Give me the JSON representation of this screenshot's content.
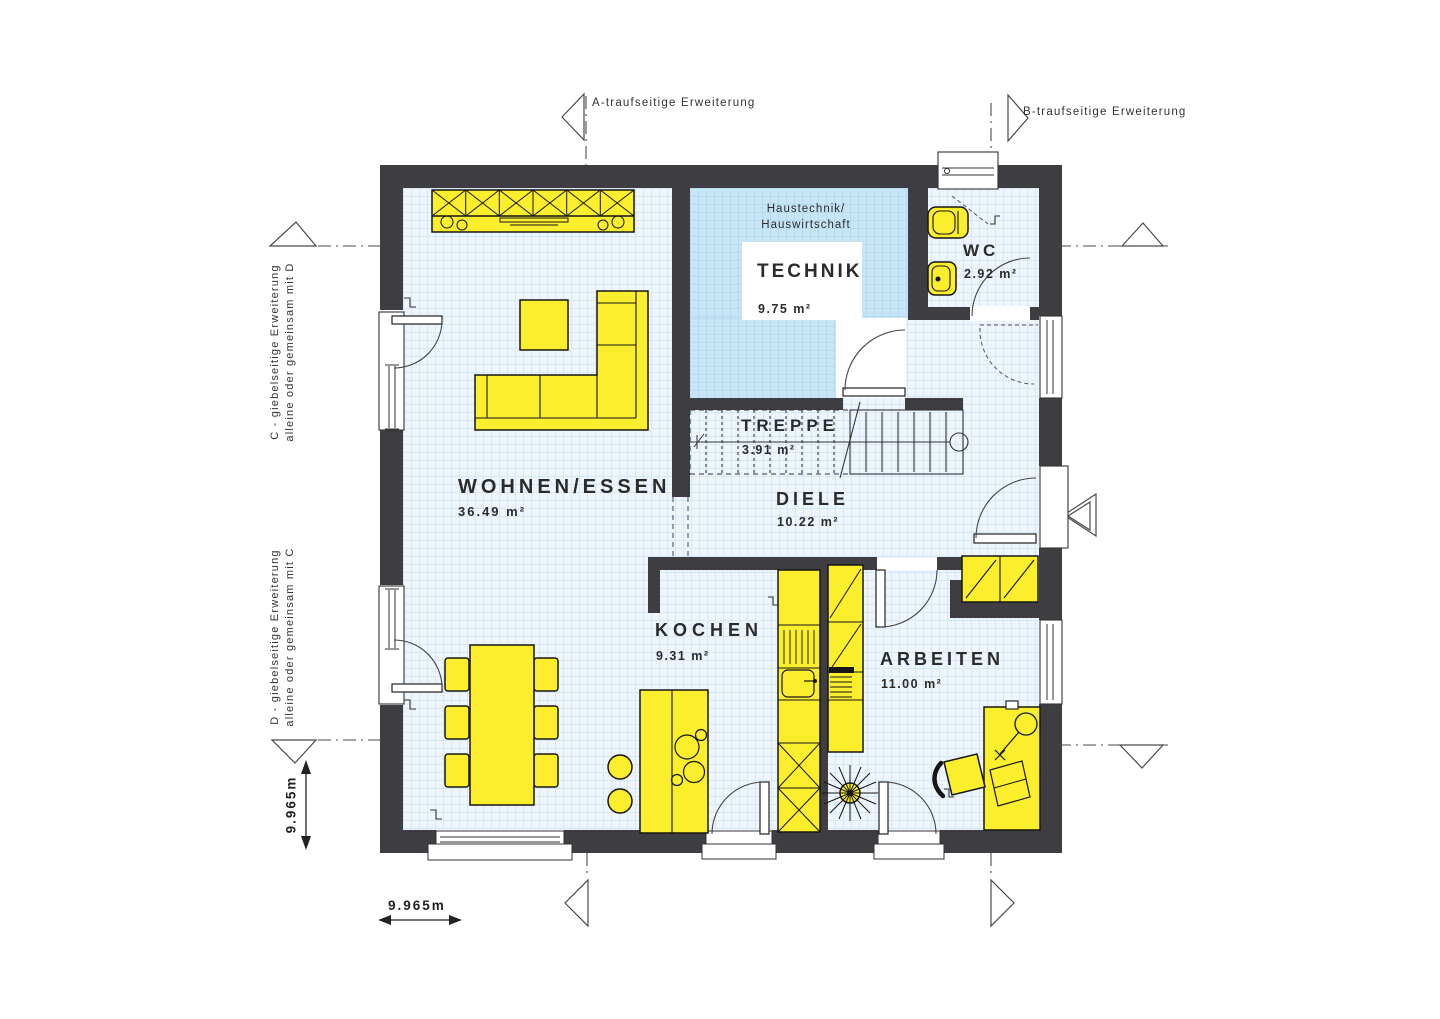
{
  "rooms": {
    "wohnen": {
      "name": "WOHNEN/ESSEN",
      "area": "36.49 m²"
    },
    "technik": {
      "name": "TECHNIK",
      "area": "9.75 m²",
      "note1": "Haustechnik/",
      "note2": "Hauswirtschaft"
    },
    "wc": {
      "name": "WC",
      "area": "2.92 m²"
    },
    "treppe": {
      "name": "TREPPE",
      "area": "3.91 m²"
    },
    "diele": {
      "name": "DIELE",
      "area": "10.22 m²"
    },
    "kochen": {
      "name": "KOCHEN",
      "area": "9.31 m²"
    },
    "arbeiten": {
      "name": "ARBEITEN",
      "area": "11.00 m²"
    }
  },
  "markers": {
    "a": "A-traufseitige Erweiterung",
    "b": "B-traufseitige Erweiterung",
    "c1": "C - giebelseitige Erweiterung",
    "c2": "alleine oder gemeinsam mit D",
    "d1": "D - giebelseitige Erweiterung",
    "d2": "alleine oder gemeinsam mit C"
  },
  "dimensions": {
    "width": "9.965m",
    "height": "9.965m"
  },
  "colors": {
    "wall": "#3e3e42",
    "furniture": "#fbee2d",
    "floor": "#eef5fc",
    "technik_floor": "#c7e5f5"
  }
}
